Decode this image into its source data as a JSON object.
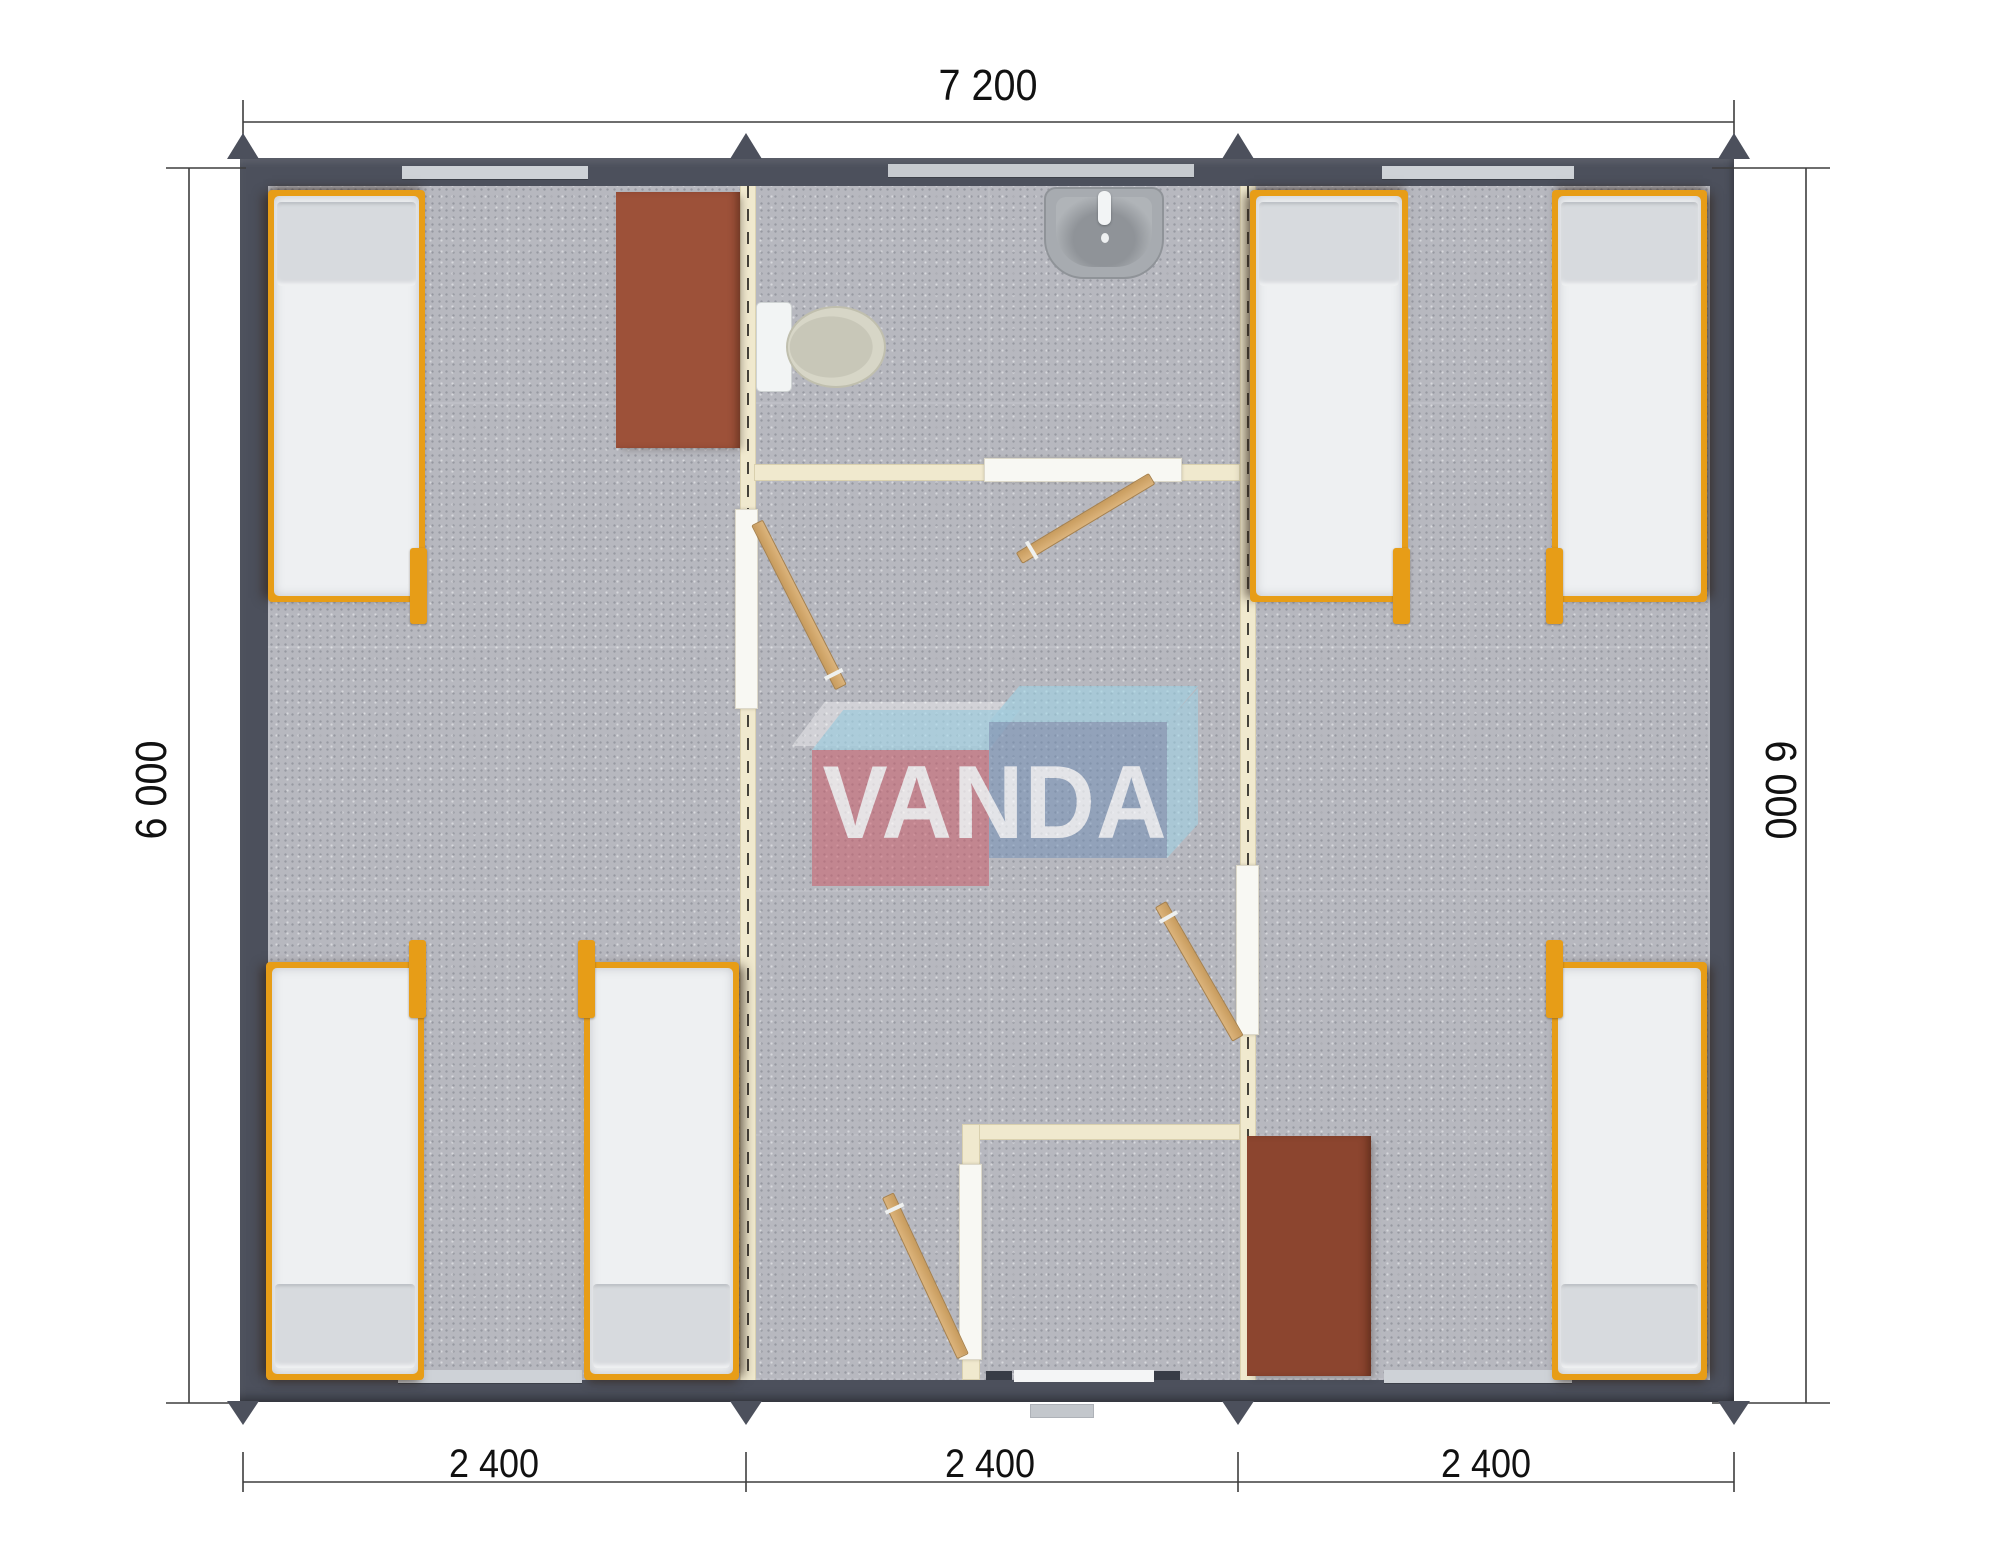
{
  "plan": {
    "dimensions": {
      "top": "7 200",
      "left": "6 000",
      "right": "6 000",
      "bottom": [
        "2 400",
        "2 400",
        "2 400"
      ]
    },
    "watermark": {
      "text": "VANDA"
    },
    "colors": {
      "wall": "#4c505c",
      "floor_carpet": "#b7b8bf",
      "partition": "#f0e9ce",
      "bed_frame": "#e79d17",
      "mattress": "#eef0f2",
      "table_left": "#9d5139",
      "table_right": "#8c452f",
      "door_leaf": "#d0a76c",
      "logo_red": "#cb5e6b",
      "logo_blue": "#7490b6",
      "logo_lightblue": "#9ed5e7"
    },
    "contents": {
      "beds": 6,
      "tables": 2,
      "toilets": 1,
      "sinks": 1,
      "door_leaves": 4
    }
  }
}
